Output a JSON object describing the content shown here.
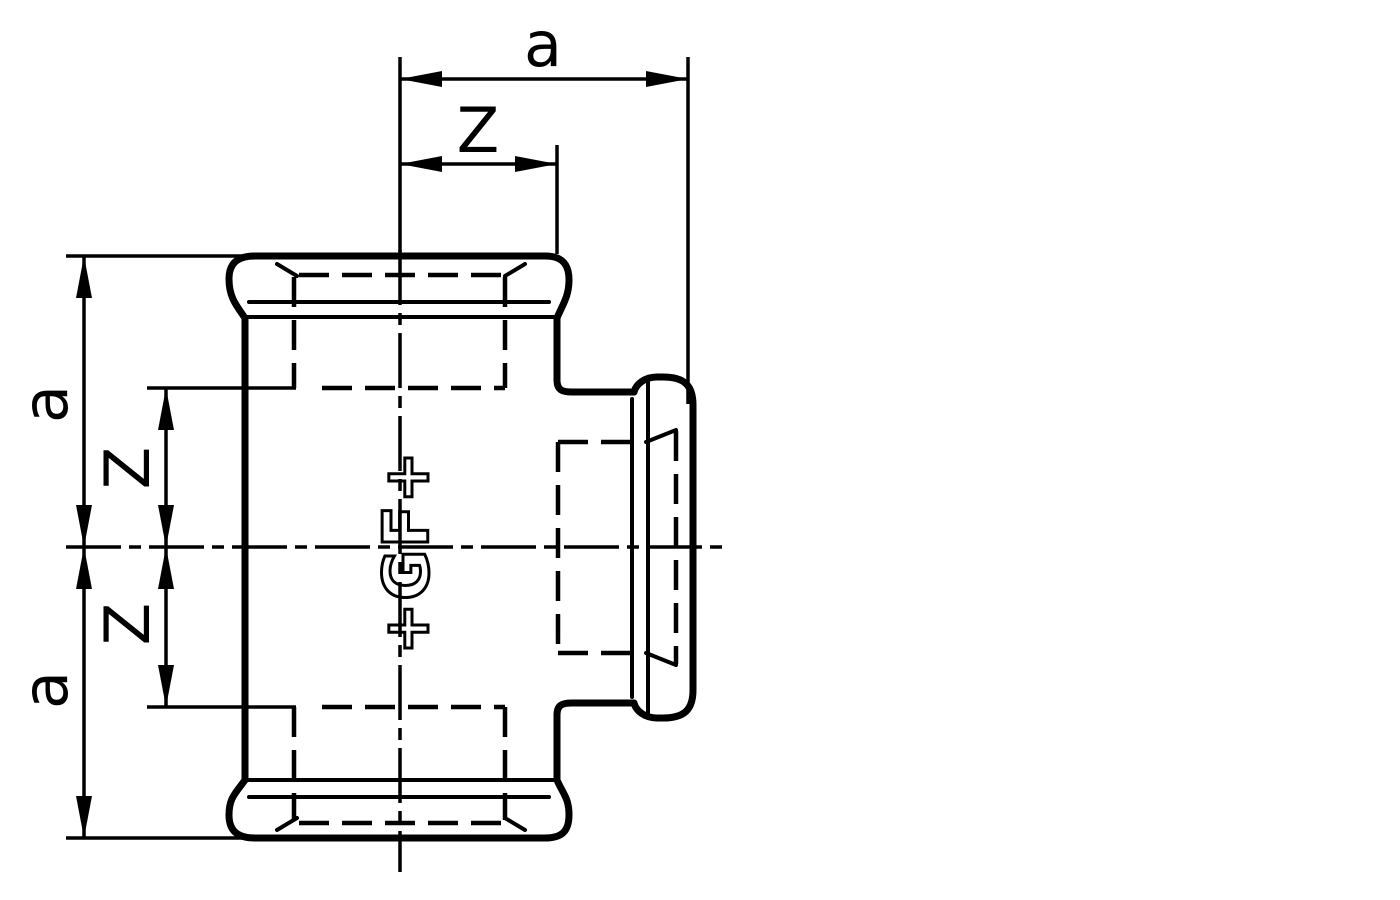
{
  "colors": {
    "background": "#ffffff",
    "line": "#000000"
  },
  "dimensions": {
    "top_a": "a",
    "top_z": "Z",
    "left_upper_a": "a",
    "left_upper_z": "Z",
    "left_lower_z": "Z",
    "left_lower_a": "a"
  },
  "logo_text": "+GF+"
}
